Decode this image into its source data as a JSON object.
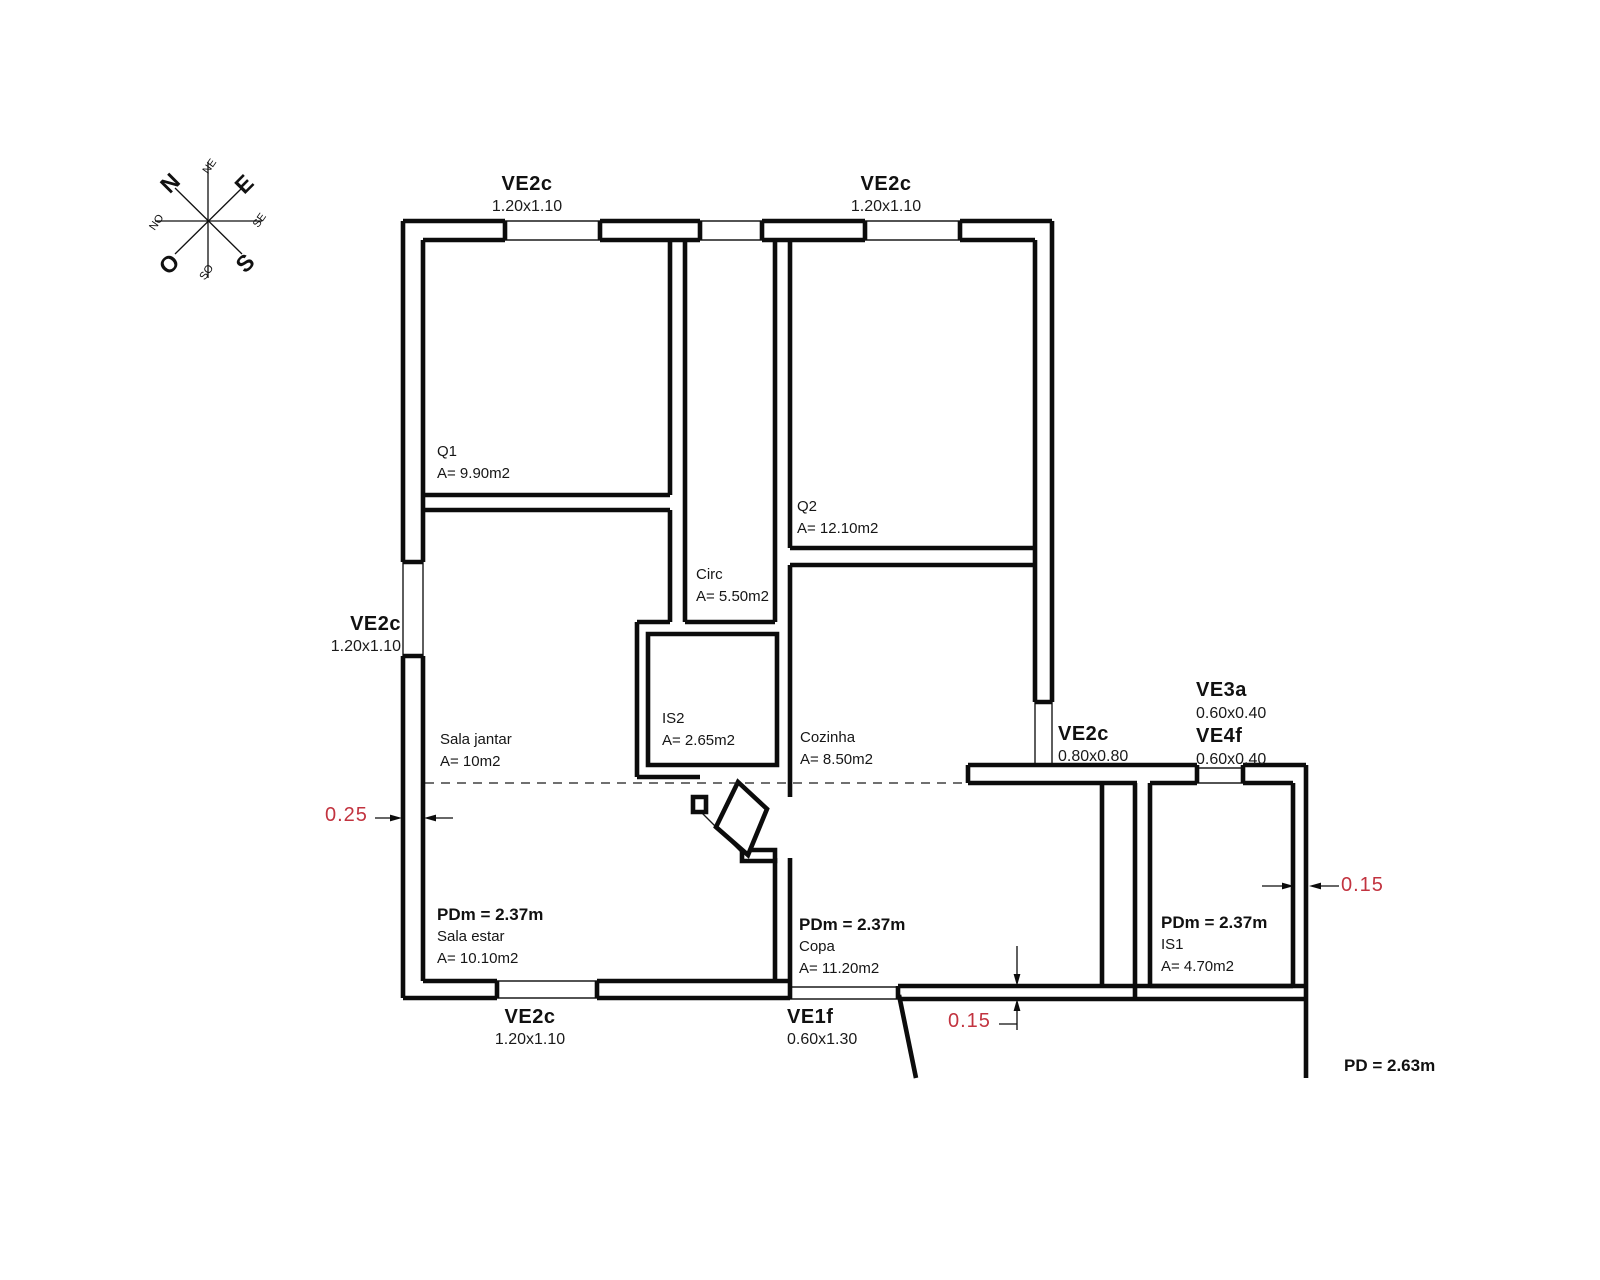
{
  "compass": {
    "n": "N",
    "e": "E",
    "s": "S",
    "o": "O",
    "ne": "NE",
    "se": "SE",
    "so": "SO",
    "no": "NO"
  },
  "openings": {
    "top_left": {
      "code": "VE2c",
      "size": "1.20x1.10"
    },
    "top_right": {
      "code": "VE2c",
      "size": "1.20x1.10"
    },
    "left": {
      "code": "VE2c",
      "size": "1.20x1.10"
    },
    "bottom_left": {
      "code": "VE2c",
      "size": "1.20x1.10"
    },
    "bottom_door": {
      "code": "VE1f",
      "size": "0.60x1.30"
    },
    "kitchen_right": {
      "code": "VE2c",
      "size": "0.80x0.80"
    },
    "right_high": {
      "code": "VE3a",
      "size": "0.60x0.40"
    },
    "right_low": {
      "code": "VE4f",
      "size": "0.60x0.40"
    }
  },
  "rooms": {
    "q1": {
      "name": "Q1",
      "area": "A= 9.90m2"
    },
    "q2": {
      "name": "Q2",
      "area": "A= 12.10m2"
    },
    "circ": {
      "name": "Circ",
      "area": "A= 5.50m2"
    },
    "is2": {
      "name": "IS2",
      "area": "A= 2.65m2"
    },
    "cozinha": {
      "name": "Cozinha",
      "area": "A= 8.50m2"
    },
    "sala_jantar": {
      "name": "Sala jantar",
      "area": "A= 10m2"
    },
    "sala_estar": {
      "ceiling": "PDm = 2.37m",
      "name": "Sala estar",
      "area": "A= 10.10m2"
    },
    "copa": {
      "ceiling": "PDm = 2.37m",
      "name": "Copa",
      "area": "A= 11.20m2"
    },
    "is1": {
      "ceiling": "PDm = 2.37m",
      "name": "IS1",
      "area": "A= 4.70m2"
    }
  },
  "dimensions": {
    "left_wall": "0.25",
    "bottom_wall": "0.15",
    "right_wall": "0.15",
    "ceiling_height": "PD = 2.63m"
  },
  "colors": {
    "lines": "#000000",
    "dimension_text": "#c2333f"
  }
}
